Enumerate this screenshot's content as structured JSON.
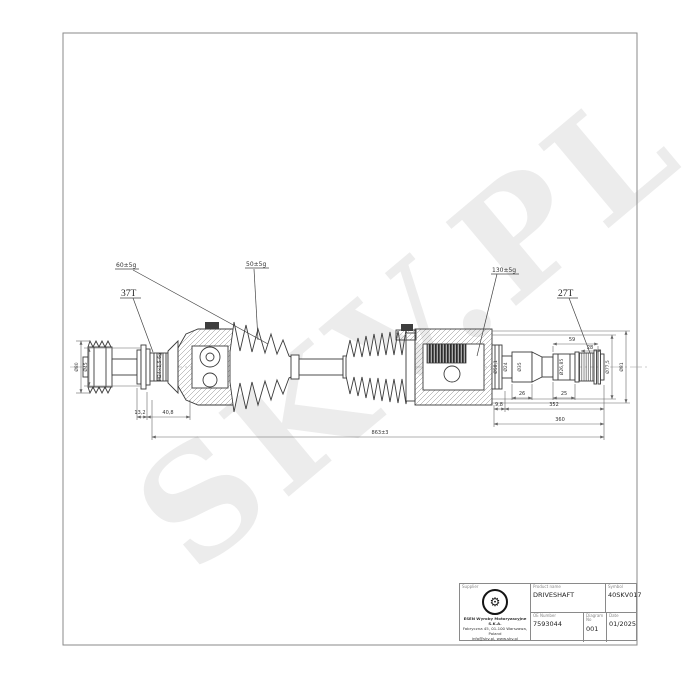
{
  "watermark": "SKV.PL",
  "colors": {
    "line": "#3b3b3b",
    "dim_line": "#666666",
    "watermark": "#ececec",
    "frame": "#8a8a8a"
  },
  "drawing": {
    "callouts": {
      "grease_outer": "60±5g",
      "grease_mid": "50±5g",
      "grease_inner": "130±5g",
      "spline_left": "37T",
      "spline_right": "27T",
      "thread": "M24×1,5-6g"
    },
    "diameters": {
      "abs_ring": "Ø80",
      "left_seat": "Ø45",
      "boot_seat": "Ø58,1",
      "neck": "Ø24",
      "step": "Ø35",
      "spline_seat": "Ø26,85",
      "joint_inner": "Ø77,5",
      "joint_outer": "Ø81"
    },
    "lengths": {
      "washer": "13,2",
      "left_joint": "40,8",
      "tip": "9,8",
      "stub": "352",
      "stub_total": "360",
      "step_len": "26",
      "seat_len": "25",
      "spline_a": "59",
      "spline_b": "28",
      "total": "863±3"
    }
  },
  "title_block": {
    "supplier_label": "Supplier",
    "product_label": "Product name",
    "product_value": "DRIVESHAFT",
    "symbol_label": "Symbol",
    "symbol_value": "40SKV017",
    "oe_label": "OE Number",
    "oe_value": "7593044",
    "diagram_label": "Diagram No",
    "diagram_value": "001",
    "date_label": "Date",
    "date_value": "01/2025",
    "logo_gear": "⚙",
    "company_line1": "ESEN Wyroby Motoryzacyjne S.K.A.",
    "company_line2": "Fabryczna 45, 01-100 Warszawa, Poland",
    "company_line3": "info@skv.pl, www.skv.pl"
  }
}
